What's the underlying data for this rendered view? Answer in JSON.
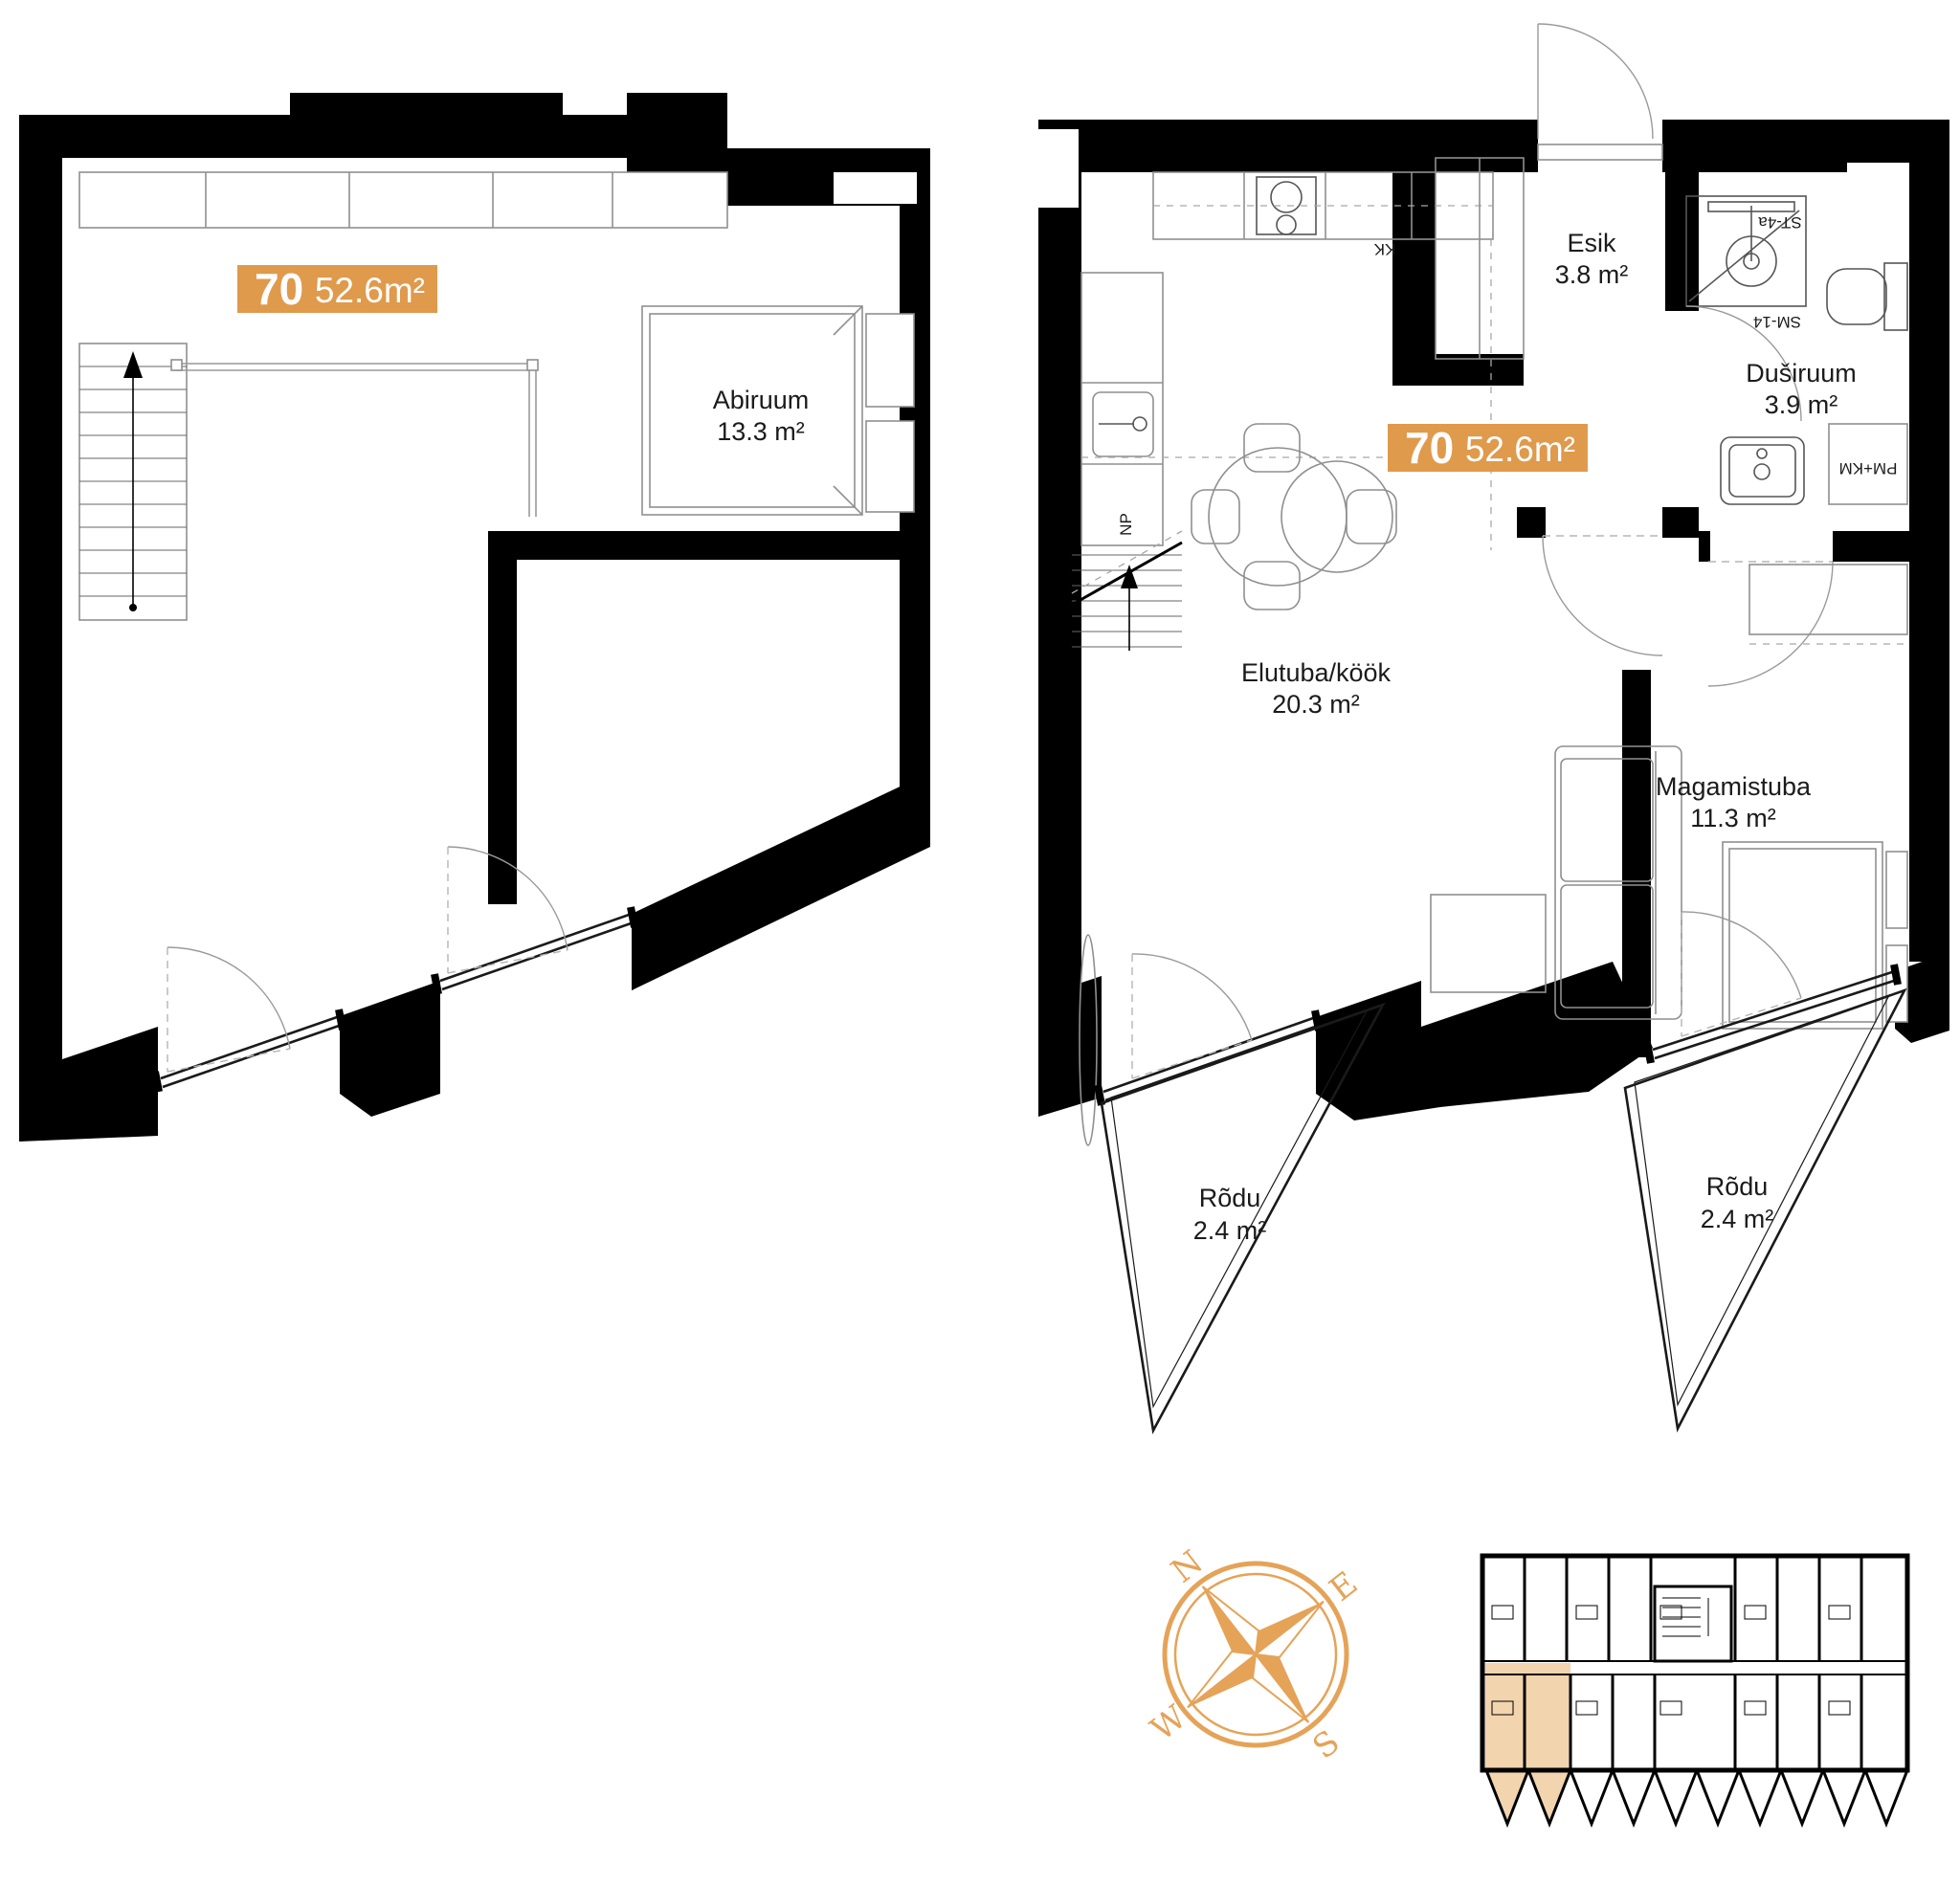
{
  "upper_plan": {
    "badge": {
      "number": "70",
      "area": "52.6m²"
    },
    "room": {
      "name": "Abiruum",
      "area": "13.3 m²"
    }
  },
  "main_plan": {
    "badge": {
      "number": "70",
      "area": "52.6m²"
    },
    "rooms": {
      "esik": {
        "name": "Esik",
        "area": "3.8 m²"
      },
      "dusiruum": {
        "name": "Duširuum",
        "area": "3.9 m²"
      },
      "elutuba": {
        "name": "Elutuba/köök",
        "area": "20.3 m²"
      },
      "magamistuba": {
        "name": "Magamistuba",
        "area": "11.3 m²"
      },
      "rodu1": {
        "name": "Rõdu",
        "area": "2.4 m²"
      },
      "rodu2": {
        "name": "Rõdu",
        "area": "2.4 m²"
      }
    },
    "fixtures": {
      "shower_code": "ST-4a",
      "module_code": "SM-14",
      "washer_code": "PM+KM",
      "kitchen_code": "KK",
      "stair_code": "NP"
    }
  },
  "compass": {
    "north": "N",
    "east": "E",
    "south": "S",
    "west": "W"
  },
  "colors": {
    "accent": "#DF9A4C",
    "compass": "#E5A358",
    "highlight": "#F2D4AF"
  }
}
